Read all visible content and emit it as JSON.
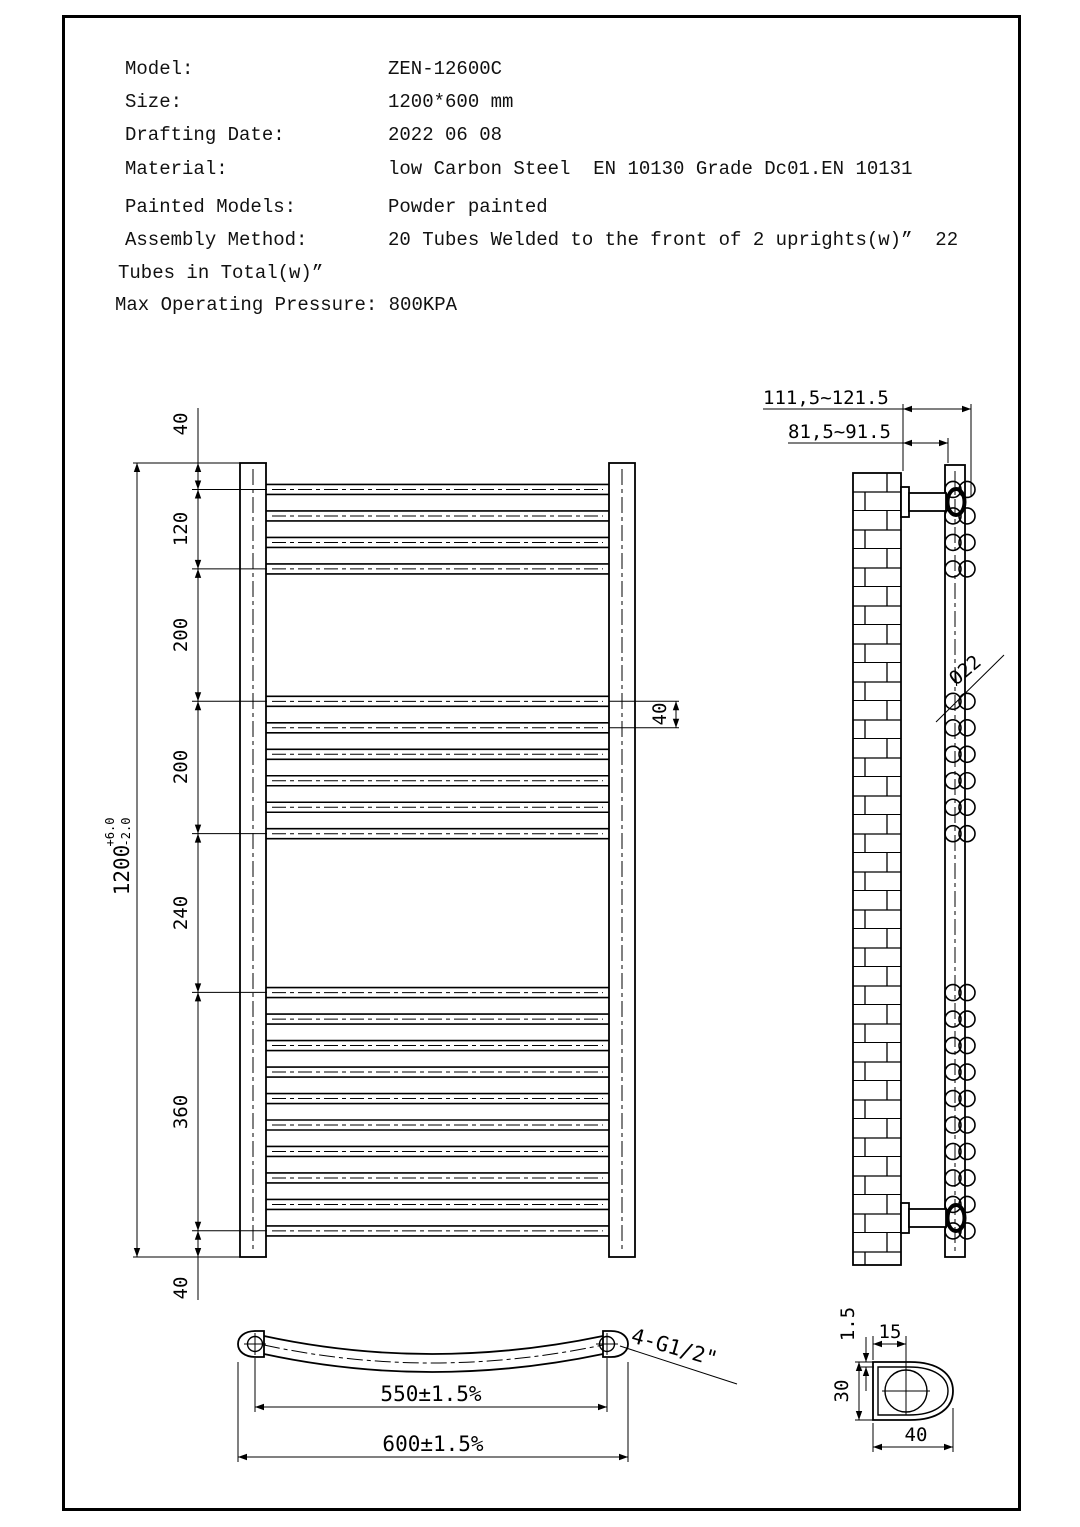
{
  "header": {
    "rows": [
      {
        "label": "Model:",
        "value": "ZEN-12600C"
      },
      {
        "label": "Size:",
        "value": "1200*600 mm"
      },
      {
        "label": "Drafting Date:",
        "value": "2022 06 08"
      },
      {
        "label": "Material:",
        "value": "low Carbon Steel  EN 10130 Grade Dc01.EN 10131"
      },
      {
        "label": "Painted Models:",
        "value": "Powder painted"
      },
      {
        "label": "Assembly Method:",
        "value": "20 Tubes Welded to the front of 2 uprights(w)”  22"
      }
    ],
    "continuation": "Tubes in Total(w)”",
    "pressure": "Max Operating Pressure: 800KPA"
  },
  "front_view": {
    "overall_dim": "1200",
    "overall_tol_upper": "+6.0",
    "overall_tol_lower": "-2.0",
    "chain_dims": [
      "40",
      "120",
      "200",
      "200",
      "240",
      "360",
      "40"
    ],
    "tube_pitch_dim": "40"
  },
  "side_view": {
    "wall_to_tube_dim": "111,5~121.5",
    "wall_to_upright_dim": "81,5~91.5",
    "tube_diameter_label": "Ø22"
  },
  "bottom_view": {
    "tap_centers_dim": "550±1.5%",
    "overall_width_dim": "600±1.5%",
    "thread_label": "4-G1/2\""
  },
  "detail_view": {
    "wall_thickness_dim": "1.5",
    "hole_offset_dim": "15",
    "profile_height_dim": "30",
    "profile_width_dim": "40"
  }
}
